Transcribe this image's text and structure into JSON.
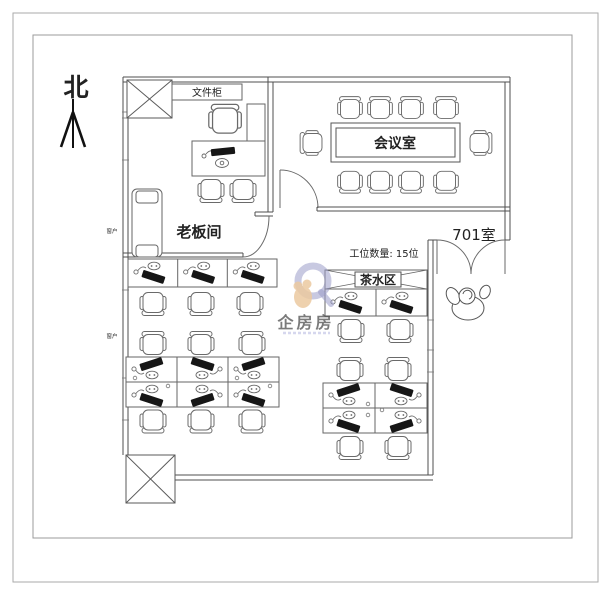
{
  "labels": {
    "north": "北",
    "file_cabinet": "文件柜",
    "boss_office": "老板间",
    "meeting_room": "会议室",
    "room_701": "701室",
    "workstation_count": "工位数量: 15位",
    "tea_area": "茶水区",
    "window": "窗户"
  },
  "watermark": {
    "text": "企房房"
  },
  "colors": {
    "frame": "#aaaaaa",
    "wall": "#4f4f4f",
    "furniture": "#666666",
    "monitor": "#161616",
    "text": "#222222",
    "watermark_blue": "#9b9cc9",
    "watermark_orange": "#e59a57"
  }
}
